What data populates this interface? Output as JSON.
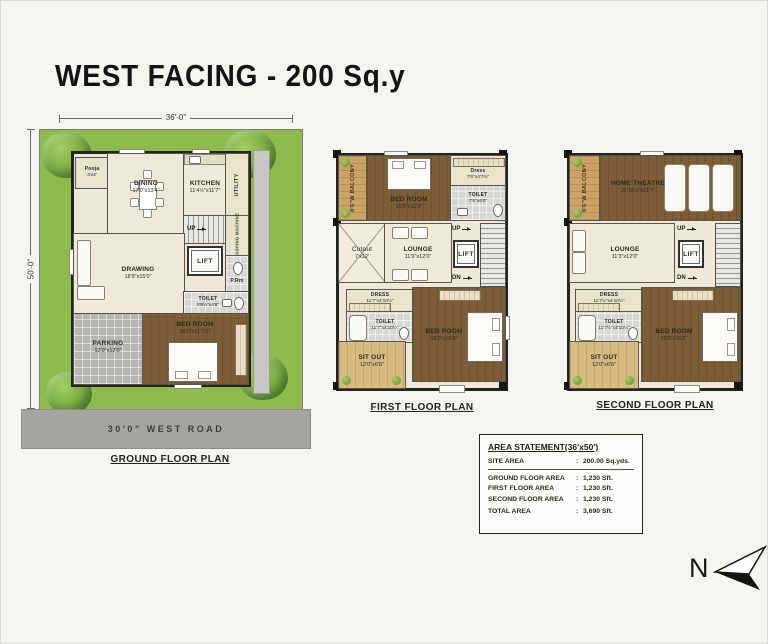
{
  "title": "WEST FACING - 200 Sq.y",
  "north": {
    "label": "N"
  },
  "area_statement": {
    "title": "AREA STATEMENT(36'x50')",
    "colon": ":",
    "rows": [
      {
        "label": "SITE AREA",
        "value": "200.00 Sq.yds."
      },
      {
        "label": "GROUND FLOOR AREA",
        "value": "1,230 Sft."
      },
      {
        "label": "FIRST FLOOR AREA",
        "value": "1,230 Sft."
      },
      {
        "label": "SECOND FLOOR AREA",
        "value": "1,230 Sft."
      },
      {
        "label": "TOTAL AREA",
        "value": "3,690 Sft."
      }
    ]
  },
  "ground_floor": {
    "caption": "GROUND FLOOR PLAN",
    "dim_width": "36'-0\"",
    "dim_height": "50'-0\"",
    "road": "30'0\"  WEST  ROAD",
    "rooms": {
      "pooja": {
        "name": "Pooja",
        "dims": "4'x4'"
      },
      "dining": {
        "name": "DINING",
        "dims": "17'0\"x13'4\""
      },
      "kitchen": {
        "name": "KITCHEN",
        "dims": "11'4½\"x11'7\""
      },
      "utility": {
        "name": "UTILITY"
      },
      "stairs": {
        "name": "UP"
      },
      "washing": {
        "name": "WASHING MACHINE"
      },
      "lift": {
        "name": "LIFT"
      },
      "prm": {
        "name": "P.Rm"
      },
      "drawing": {
        "name": "DRAWING",
        "dims": "18'9\"x15'0\""
      },
      "toilet": {
        "name": "TOILET",
        "dims": "9'6½\"x4'8\""
      },
      "bedroom": {
        "name": "BED ROOM",
        "dims": "16'0\"x11'7½\""
      },
      "parking": {
        "name": "PARKING",
        "dims": "12'0\"x12'0\""
      }
    }
  },
  "first_floor": {
    "caption": "FIRST FLOOR PLAN",
    "rooms": {
      "balcony": {
        "name": "8'6\"W BALCONY"
      },
      "bedroom_top": {
        "name": "BED ROOM",
        "dims": "15'0\"x11'0\""
      },
      "dress_top": {
        "name": "Dress",
        "dims": "7'6\"x4'7½\""
      },
      "toilet_top": {
        "name": "TOILET",
        "dims": "7'6\"x6'0\""
      },
      "cutout": {
        "name": "Cutout",
        "dims": "7'x12'"
      },
      "lounge": {
        "name": "LOUNGE",
        "dims": "11'9\"x12'0\""
      },
      "up": "UP",
      "dn": "DN",
      "lift": "LIFT",
      "dress_bottom": {
        "name": "DRESS",
        "dims": "11'7\"x4'10½\""
      },
      "toilet_bottom": {
        "name": "TOILET",
        "dims": "11'7\"x4'10½\""
      },
      "sitout": {
        "name": "SIT OUT",
        "dims": "12'0\"x6'6\""
      },
      "bedroom_bottom": {
        "name": "BED ROOM",
        "dims": "16'0\"x16'6\""
      }
    }
  },
  "second_floor": {
    "caption": "SECOND FLOOR PLAN",
    "rooms": {
      "balcony": {
        "name": "6'6\"W BALCONY"
      },
      "home_theatre": {
        "name": "HOME THEATRE",
        "dims": "21'10½\"x11'7\""
      },
      "lounge": {
        "name": "LOUNGE",
        "dims": "11'3\"x12'0\""
      },
      "up": "UP",
      "dn": "DN",
      "lift": "LIFT",
      "dress": {
        "name": "DRESS",
        "dims": "11'7½\"x4'10½\""
      },
      "toilet": {
        "name": "TOILET",
        "dims": "11'7½\"x4'10½\""
      },
      "sitout": {
        "name": "SIT OUT",
        "dims": "12'0\"x6'6\""
      },
      "bedroom": {
        "name": "BED ROOM",
        "dims": "16'0\"x16'6\""
      }
    }
  }
}
